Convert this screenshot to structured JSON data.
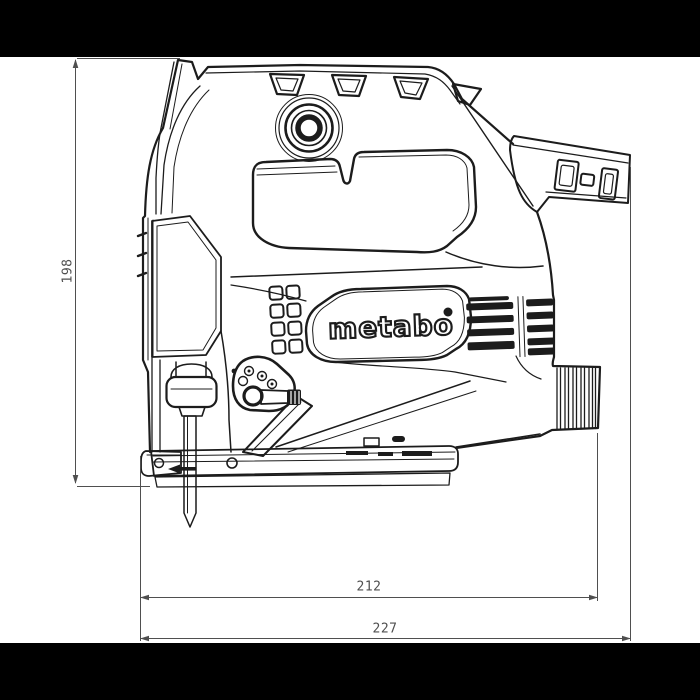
{
  "colors": {
    "letterbox": "#000000",
    "canvas": "#ffffff",
    "line": "#1c1c1c",
    "dim": "#4f4f4f"
  },
  "brand": {
    "logo": "metabo"
  },
  "dimensions": {
    "height": {
      "label": "198"
    },
    "body_length": {
      "label": "212"
    },
    "overall_length": {
      "label": "227"
    }
  }
}
